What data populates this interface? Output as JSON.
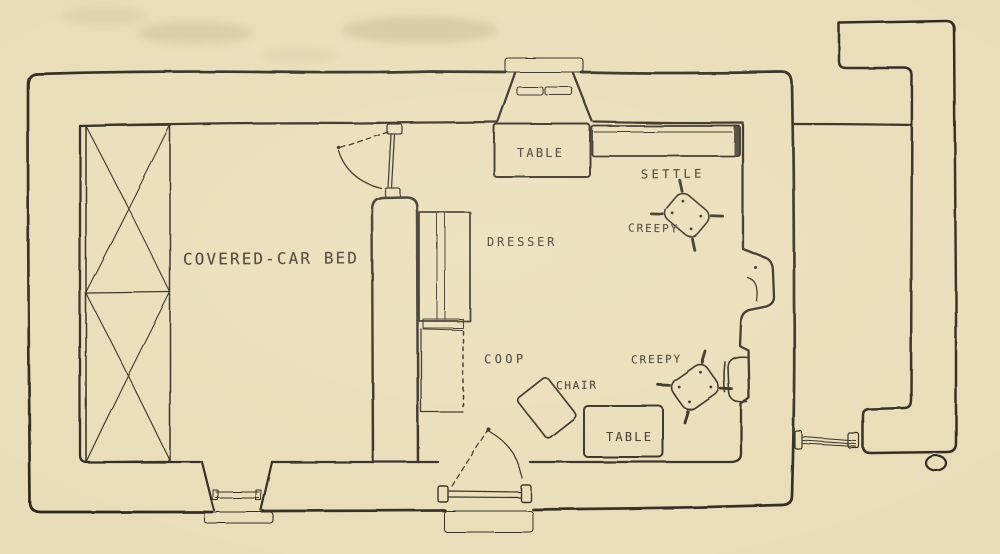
{
  "figure": {
    "kind": "hand-drawn cottage floor plan",
    "colors": {
      "paper": "#e9dcb8",
      "ink": "#2d271e",
      "text": "#3c342a",
      "stain": "#b3a27c"
    }
  },
  "labels": {
    "covered_car_bed": "COVERED-CAR BED",
    "table_top": "TABLE",
    "settle": "SETTLE",
    "creepy_top": "CREEPY",
    "dresser": "DRESSER",
    "coop": "COOP",
    "chair": "CHAIR",
    "table_bottom": "TABLE",
    "creepy_bottom": "CREEPY"
  }
}
